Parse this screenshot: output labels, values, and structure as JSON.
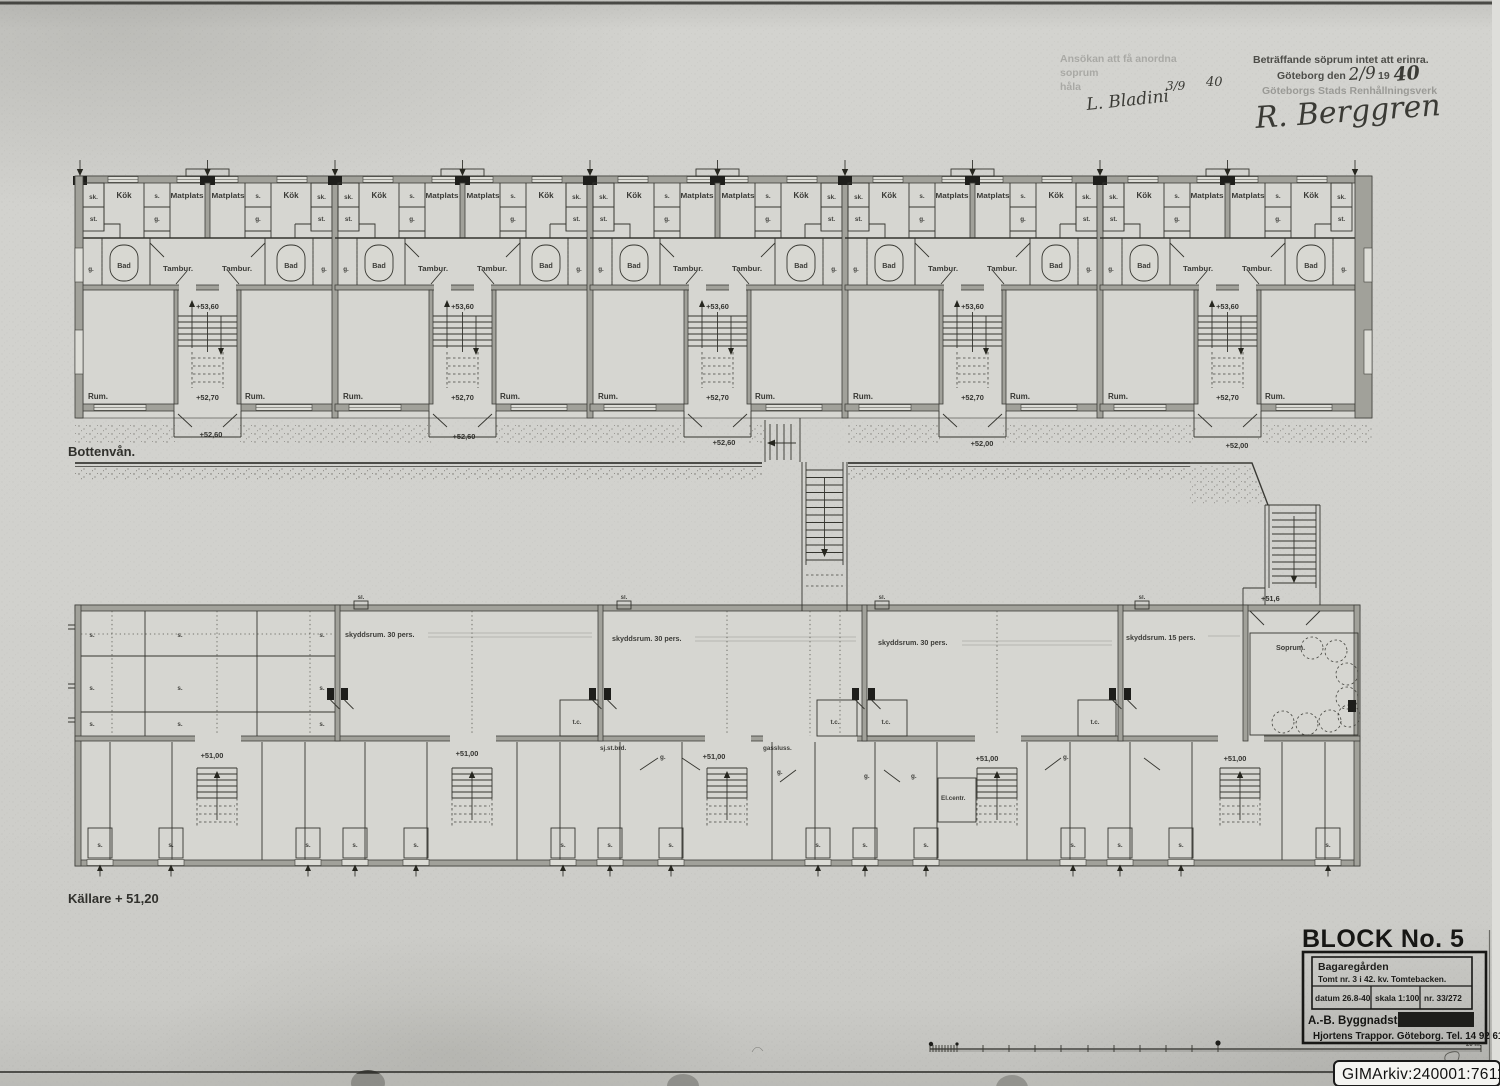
{
  "stamps": {
    "application_line1": "Ansökan att få anordna",
    "application_line2": "soprum",
    "application_line3": "håla",
    "remark_line": "Beträffande söprum intet att erinra.",
    "place_date_prefix": "Göteborg den",
    "date_handwritten": "2/9",
    "year_printed": "19",
    "year_handwritten": "40",
    "department": "Göteborgs Stads Renhållningsverk",
    "signature_left": "L. Bladini",
    "signature_left_date": "3/9",
    "signature_left_year": "40",
    "signature_right": "R. Berggren"
  },
  "ground_floor": {
    "caption": "Bottenvån.",
    "rooms": {
      "kok": "Kök",
      "matplats": "Matplats",
      "bad": "Bad",
      "tambur": "Tambur.",
      "rum": "Rum.",
      "sk": "sk.",
      "st": "st.",
      "s": "s.",
      "g": "g."
    },
    "levels": {
      "stair_upper": "+53,60",
      "stair_lower": "+52,70",
      "entry_west": "+52,60",
      "entry_east": "+52,00"
    }
  },
  "basement": {
    "caption": "Källare + 51,20",
    "rooms": {
      "shelter_30": "skyddsrum. 30 pers.",
      "shelter_15": "skyddsrum. 15 pers.",
      "soprum": "Soprum.",
      "gas_lock": "gassluss.",
      "tc": "t.c.",
      "s": "s.",
      "g": "g.",
      "sl": "sl.",
      "sick_stretcher": "sj.st.brd.",
      "el_central": "El.centr."
    },
    "levels": {
      "floor": "+51,00",
      "outdoor_stair": "+51,6"
    }
  },
  "title_block": {
    "block_title": "BLOCK No. 5",
    "project": "Bagaregården",
    "site": "Tomt nr. 3 i 42. kv. Tomtebacken.",
    "date": "datum 26.8-40",
    "scale": "skala 1:100",
    "number": "nr. 33/272",
    "company": "A.-B. Byggnadsteknik.",
    "address": "Hjortens Trappor. Göteborg. Tel. 14 92 61"
  },
  "scale_bar": {
    "end_label": "20 m."
  },
  "archive_id": "GIMArkiv:240001:7611",
  "colors": {
    "paper": "#cfcfcb",
    "ink": "#2e2e2a",
    "wall_poche": "#a1a19a",
    "stamp_ink": "#4c4c48"
  }
}
